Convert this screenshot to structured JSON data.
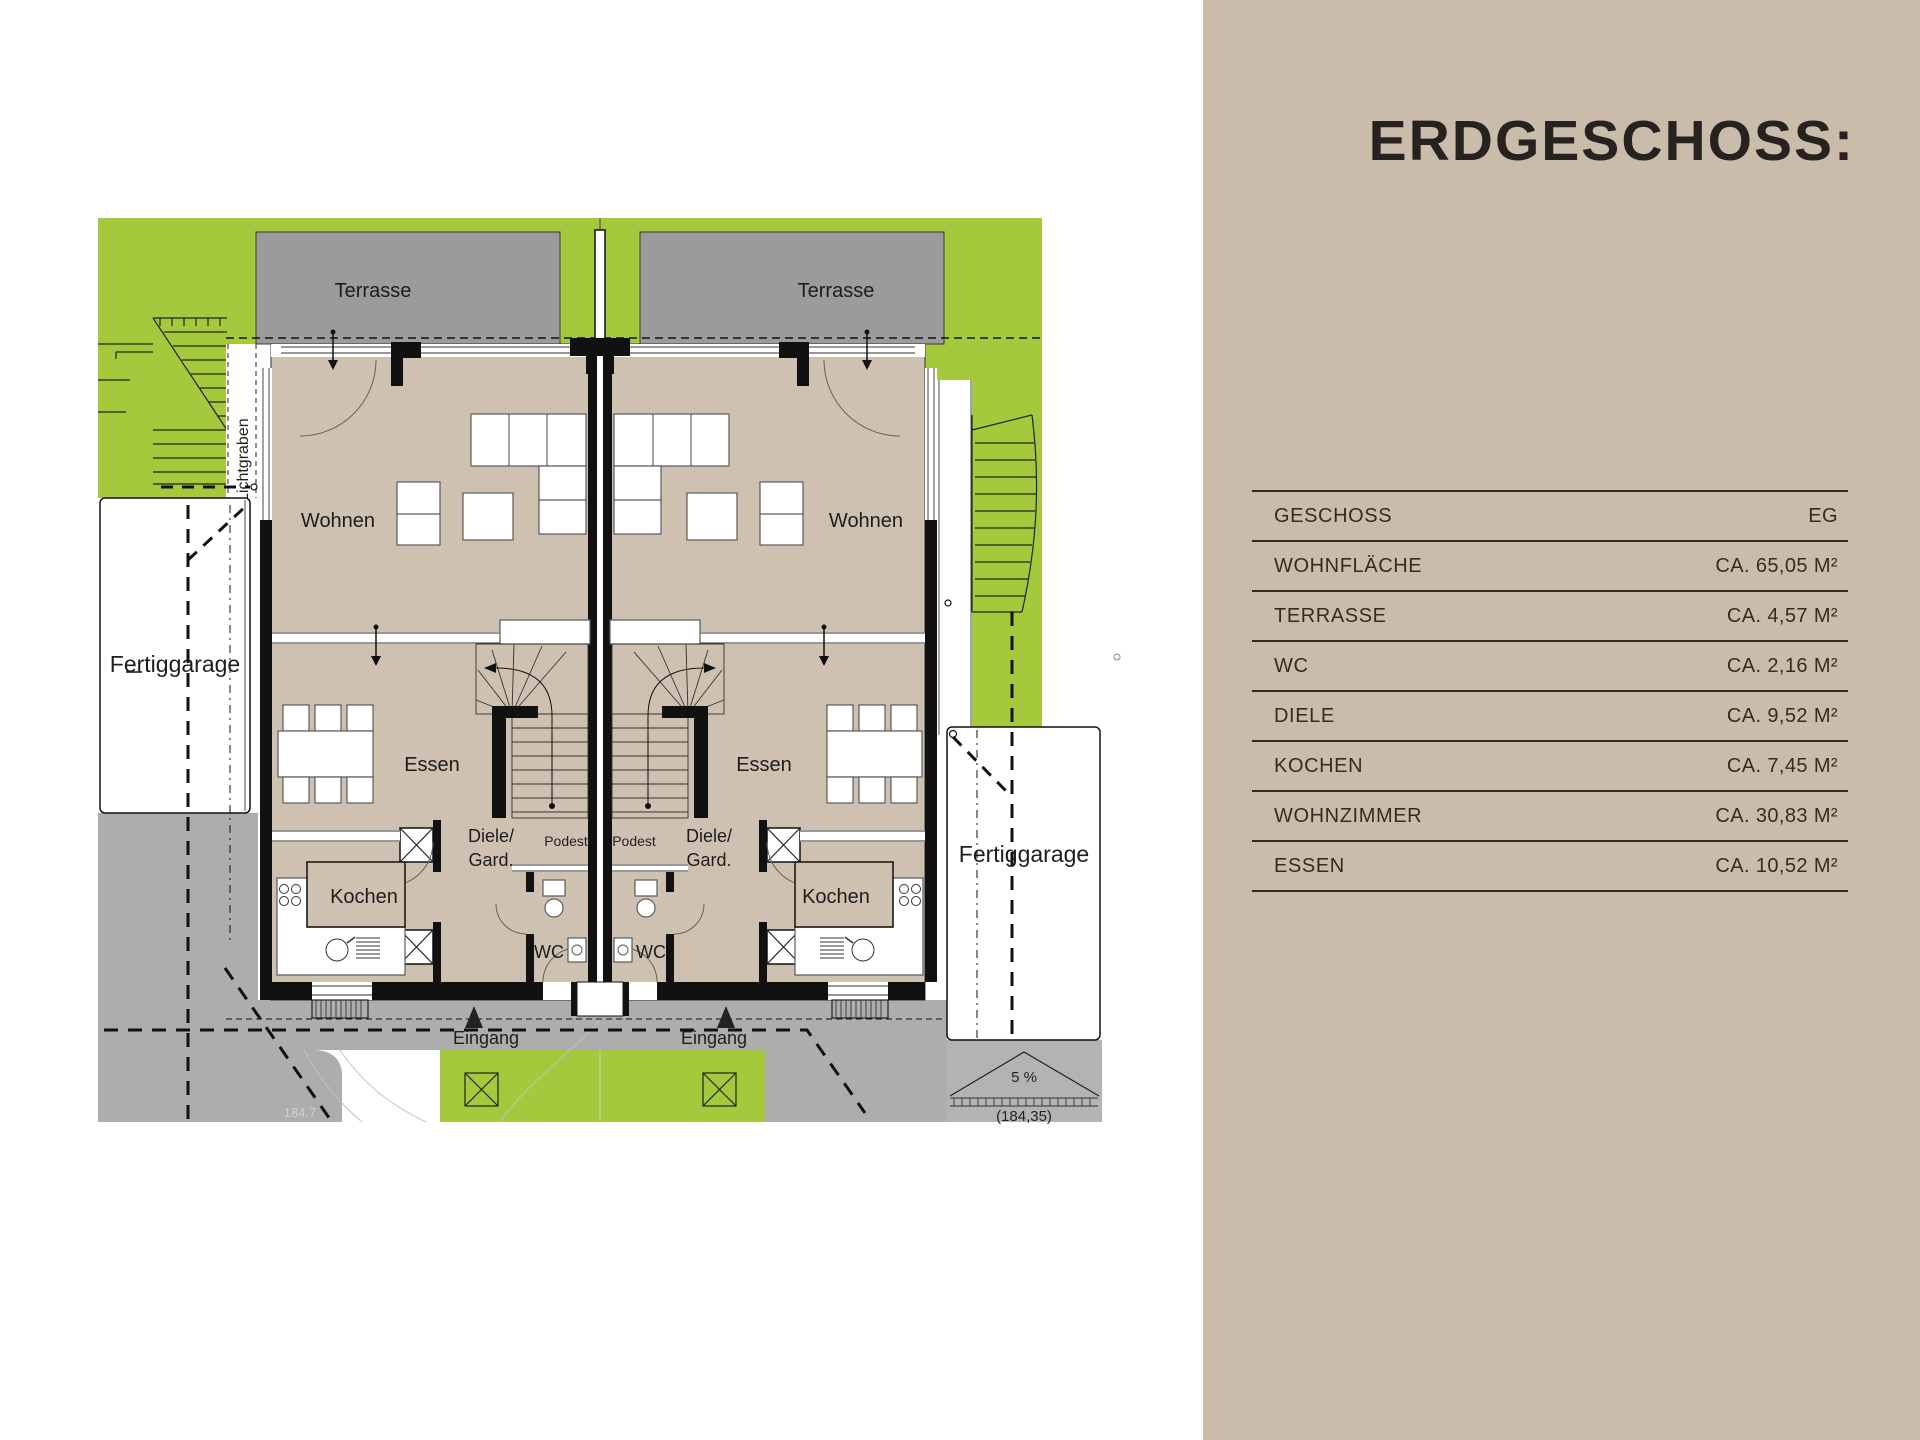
{
  "panel": {
    "title": "ERDGESCHOSS:",
    "table": {
      "rows": [
        {
          "label": "GESCHOSS",
          "value": "EG"
        },
        {
          "label": "WOHNFLÄCHE",
          "value": "CA. 65,05 M²"
        },
        {
          "label": "TERRASSE",
          "value": "CA. 4,57 M²"
        },
        {
          "label": "WC",
          "value": "CA. 2,16 M²"
        },
        {
          "label": "DIELE",
          "value": "CA. 9,52 M²"
        },
        {
          "label": "KOCHEN",
          "value": "CA. 7,45 M²"
        },
        {
          "label": "WOHNZIMMER",
          "value": "CA. 30,83 M²"
        },
        {
          "label": "ESSEN",
          "value": "CA. 10,52 M²"
        }
      ]
    },
    "bg_color": "#cabcaa",
    "text_color": "#332c25"
  },
  "plan": {
    "rooms": {
      "terrasse": "Terrasse",
      "wohnen": "Wohnen",
      "essen": "Essen",
      "kochen": "Kochen",
      "wc": "WC",
      "diele_line1": "Diele/",
      "diele_line2": "Gard.",
      "podest": "Podest"
    },
    "site": {
      "eingang": "Eingang",
      "fertiggarage": "Fertiggarage",
      "lichtgraben": "Lichtgraben",
      "slope": "5 %",
      "level_value": "(184,35)",
      "elevation_point": "184.7"
    },
    "colors": {
      "lawn": "#a4c93c",
      "terrace": "#9b9b9b",
      "floor": "#cfc1b1",
      "paving": "#adadad",
      "wall": "#111111"
    }
  }
}
